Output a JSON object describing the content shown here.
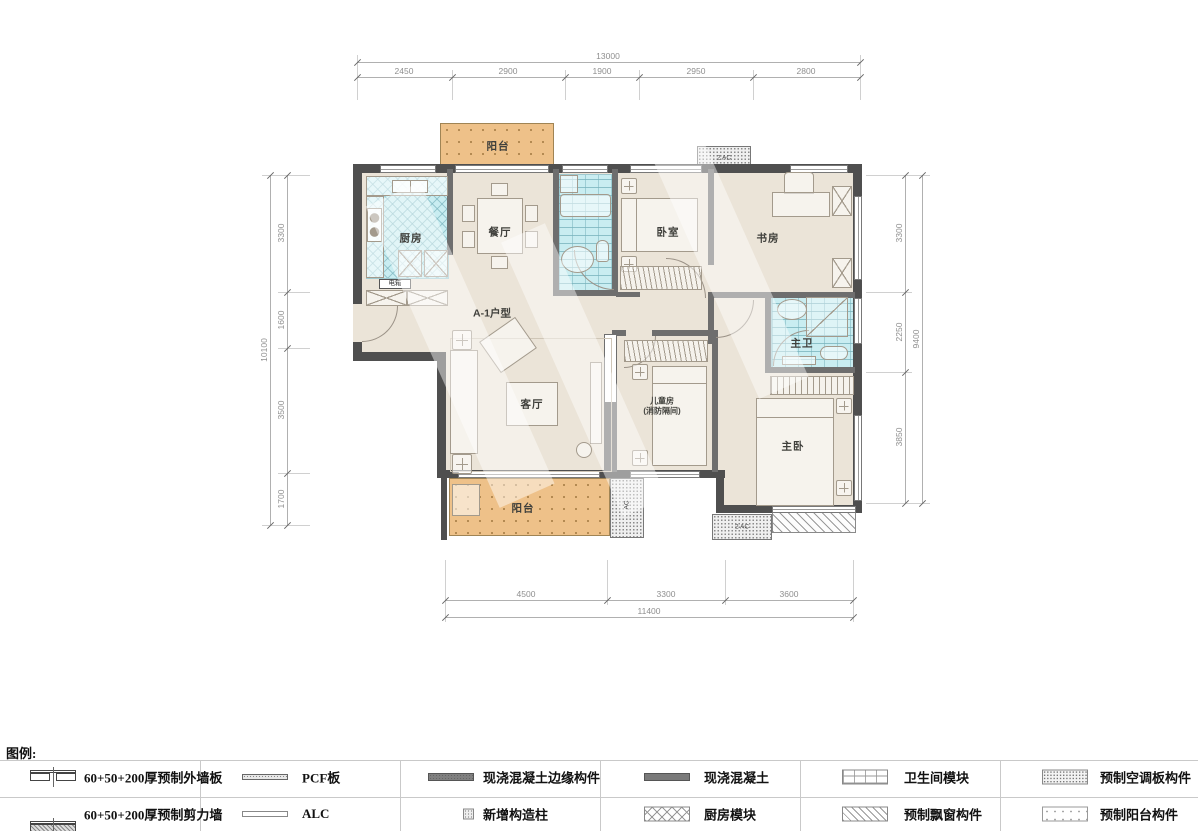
{
  "plan": {
    "unit_label": "A-1户型",
    "rooms": {
      "kitchen": "厨房",
      "dining": "餐厅",
      "bedroom": "卧室",
      "study": "书房",
      "living": "客厅",
      "children_line1": "儿童房",
      "children_line2": "(消防隔间)",
      "master_bedroom": "主卧",
      "master_bath": "主卫",
      "balcony_top": "阳台",
      "balcony_bottom": "阳台",
      "electric_box": "电箱",
      "ac_top": "2 AC",
      "ac_bottom": "2 AC",
      "ac_side": "AC"
    }
  },
  "dims": {
    "top": {
      "total": "13000",
      "segments": [
        "2450",
        "2900",
        "1900",
        "2950",
        "2800"
      ]
    },
    "left": {
      "total": "10100",
      "segments": [
        "3300",
        "1600",
        "3500",
        "1700"
      ]
    },
    "right": {
      "total": "9400",
      "segments": [
        "3300",
        "2250",
        "3850"
      ]
    },
    "bottom": {
      "total": "11400",
      "segments": [
        "4500",
        "3300",
        "3600"
      ]
    }
  },
  "legend": {
    "heading": "图例:",
    "items": [
      {
        "icon": "precast-exterior-wall-panel-symbol",
        "label": "60+50+200厚预制外墙板"
      },
      {
        "icon": "precast-shear-wall-symbol",
        "label": "60+50+200厚预制剪力墙"
      },
      {
        "icon": "pcf-board-symbol",
        "label": "PCF板"
      },
      {
        "icon": "alc-symbol",
        "label": "ALC"
      },
      {
        "icon": "cast-in-place-concrete-edge-symbol",
        "label": "现浇混凝土边缘构件"
      },
      {
        "icon": "new-constructional-column-symbol",
        "label": "新增构造柱"
      },
      {
        "icon": "cast-in-place-concrete-symbol",
        "label": "现浇混凝土"
      },
      {
        "icon": "kitchen-module-symbol",
        "label": "厨房模块"
      },
      {
        "icon": "bathroom-module-symbol",
        "label": "卫生间模块"
      },
      {
        "icon": "precast-bay-window-symbol",
        "label": "预制飘窗构件"
      },
      {
        "icon": "precast-ac-panel-symbol",
        "label": "预制空调板构件"
      },
      {
        "icon": "precast-balcony-symbol",
        "label": "预制阳台构件"
      }
    ]
  },
  "colors": {
    "wall": "#4f4f4f",
    "floor": "#ebe4d8",
    "tile": "#c9edf1",
    "balcony": "#eec189",
    "dim_text": "#8f8f8f"
  }
}
